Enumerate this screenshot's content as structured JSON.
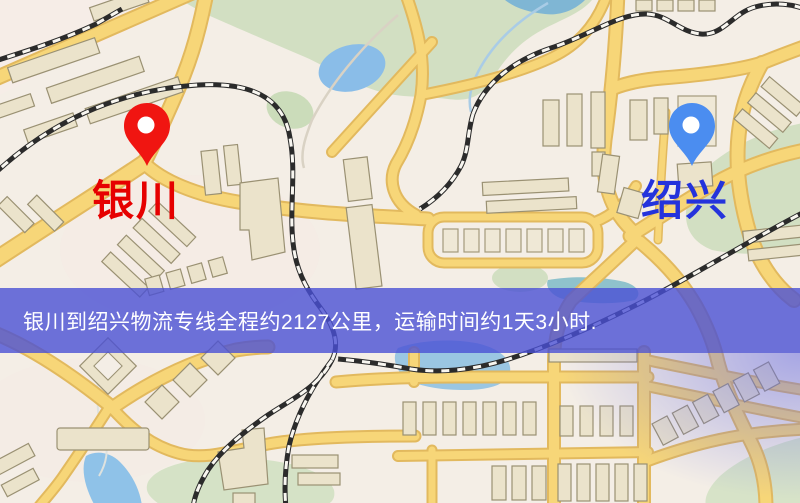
{
  "banner": {
    "text": "银川到绍兴物流专线全程约2127公里，运输时间约1天3小时.",
    "background_color": "#4a50d4",
    "text_color": "#ffffff"
  },
  "markers": {
    "origin": {
      "name": "银川",
      "pin_icon": "map-pin-icon",
      "pin_color": "#f01511",
      "label_color": "#e60000"
    },
    "destination": {
      "name": "绍兴",
      "pin_icon": "map-pin-icon",
      "pin_color": "#4b8df0",
      "label_color": "#2433dc"
    }
  },
  "route": {
    "from": "银川",
    "to": "绍兴",
    "distance": "约2127公里",
    "duration": "约1天3小时"
  },
  "map": {
    "palette": {
      "background": "#f4eee6",
      "road": "#f7d678",
      "road_casing": "#e2b95e",
      "park": "#d2dfc2",
      "water": "#92c0e4",
      "building": "#ebe3cb",
      "railway": "#2b2b2b"
    }
  }
}
